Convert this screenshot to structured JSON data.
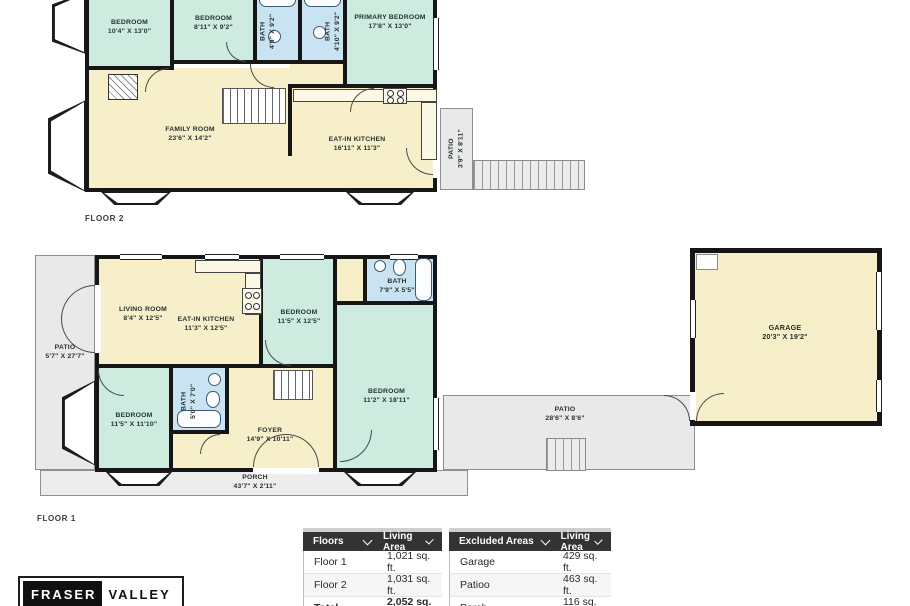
{
  "colors": {
    "bedroom_fill": "#cdecdf",
    "bath_fill": "#c9e3f2",
    "living_fill": "#f6efca",
    "patio_fill": "#e9e9e9",
    "wall": "#161616",
    "table_header_bg": "#333333"
  },
  "floor2": {
    "caption": "FLOOR 2",
    "bedroom1": {
      "name": "BEDROOM",
      "dims": "10'4\" X 13'0\""
    },
    "bedroom2": {
      "name": "BEDROOM",
      "dims": "8'11\" X 9'2\""
    },
    "bath1": {
      "name": "BATH",
      "dims": "4'9\" X 9'2\""
    },
    "bath2": {
      "name": "BATH",
      "dims": "4'10\" X 9'2\""
    },
    "primary_bedroom": {
      "name": "PRIMARY BEDROOM",
      "dims": "17'8\" X 13'0\""
    },
    "family_room": {
      "name": "FAMILY ROOM",
      "dims": "23'6\" X 14'2\""
    },
    "kitchen": {
      "name": "EAT-IN KITCHEN",
      "dims": "16'11\" X 11'3\""
    },
    "patio": {
      "name": "PATIO",
      "dims": "3'9\" X 8'11\""
    }
  },
  "floor1": {
    "caption": "FLOOR 1",
    "living_room": {
      "name": "LIVING ROOM",
      "dims": "8'4\" X 12'5\""
    },
    "kitchen": {
      "name": "EAT-IN KITCHEN",
      "dims": "11'3\" X 12'5\""
    },
    "bedroom_top": {
      "name": "BEDROOM",
      "dims": "11'5\" X 12'5\""
    },
    "bath_top": {
      "name": "BATH",
      "dims": "7'9\" X 5'5\""
    },
    "bedroom_right": {
      "name": "BEDROOM",
      "dims": "11'2\" X 18'11\""
    },
    "bedroom_left": {
      "name": "BEDROOM",
      "dims": "11'5\" X 11'10\""
    },
    "bath_center": {
      "name": "BATH",
      "dims": "5'0\" X 7'0\""
    },
    "foyer": {
      "name": "FOYER",
      "dims": "14'9\" X 10'11\""
    },
    "porch": {
      "name": "PORCH",
      "dims": "43'7\" X 2'11\""
    },
    "patio_left": {
      "name": "PATIO",
      "dims": "5'7\" X 27'7\""
    },
    "patio_right": {
      "name": "PATIO",
      "dims": "28'6\" X 8'6\""
    }
  },
  "garage": {
    "name": "GARAGE",
    "dims": "20'3\" X 19'2\""
  },
  "area_table": {
    "floors": {
      "col1": "Floors",
      "col2": "Living Area",
      "rows": [
        {
          "label": "Floor 1",
          "value": "1,021 sq. ft."
        },
        {
          "label": "Floor 2",
          "value": "1,031 sq. ft."
        },
        {
          "label": "Total",
          "value": "2,052 sq. ft."
        }
      ]
    },
    "excluded": {
      "col1": "Excluded Areas",
      "col2": "Living Area",
      "rows": [
        {
          "label": "Garage",
          "value": "429 sq. ft."
        },
        {
          "label": "Patioo",
          "value": "463 sq. ft."
        },
        {
          "label": "Porch",
          "value": "116 sq. ft."
        }
      ]
    }
  },
  "logo": {
    "part1": "FRASER",
    "part2": "VALLEY"
  }
}
